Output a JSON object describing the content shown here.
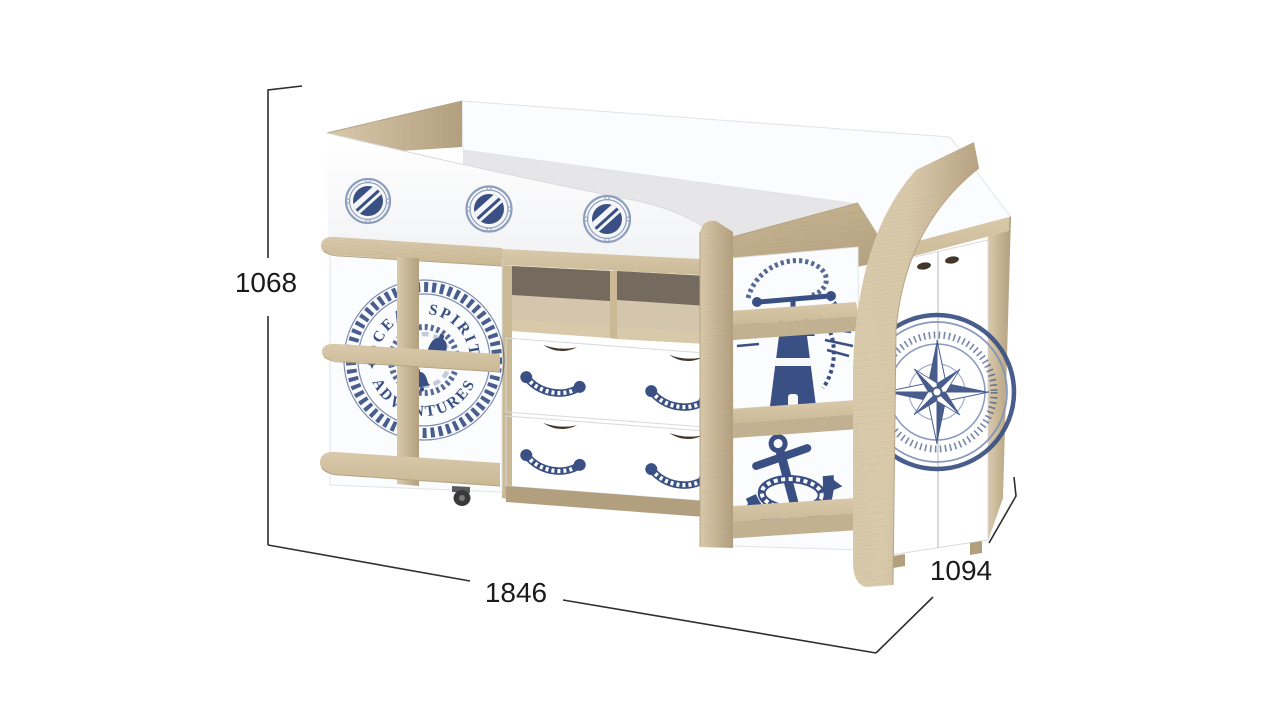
{
  "image": {
    "kind": "furniture-product-render",
    "subject": "kids-loft-bed-nautical-theme"
  },
  "dimensions": {
    "height_mm": "1068",
    "width_mm": "1846",
    "depth_mm": "1094"
  },
  "emblem": {
    "text_top": "OCEAN SPIRIT",
    "text_bottom": "ADVENTURES"
  },
  "icons": {
    "porthole": "striped-circle-with-bolted-ring",
    "lifebuoy_emblem": "rope-ring-seal-with-bells",
    "lighthouse": "navy-lighthouse-with-light-rays-and-rope",
    "anchor": "navy-anchor-with-rope-coil",
    "compass": "eight-point-compass-rose",
    "rope_handle": "rope-swag-drawer-pull",
    "caster": "black-caster-wheel"
  },
  "colors": {
    "page_bg": "#ffffff",
    "oak": "#d9c9ab",
    "oak_mid": "#cbb995",
    "oak_dark": "#b29f7e",
    "navy": "#3a5084",
    "navy_soft": "#7f92b8",
    "rope_ring": "#8fa0bf",
    "panel_white": "#fbfcfd",
    "panel_shade": "#eef0f2",
    "interior_shadow": "#e6e6e9",
    "cubby_dark": "#675f53",
    "cubby_back": "#d3c6ac",
    "scoop": "#43362a",
    "dim_line": "#2e2e2e",
    "text_black": "#1b1b1b",
    "caster": "#3a3a3a",
    "grain": "#8a7a5d"
  }
}
